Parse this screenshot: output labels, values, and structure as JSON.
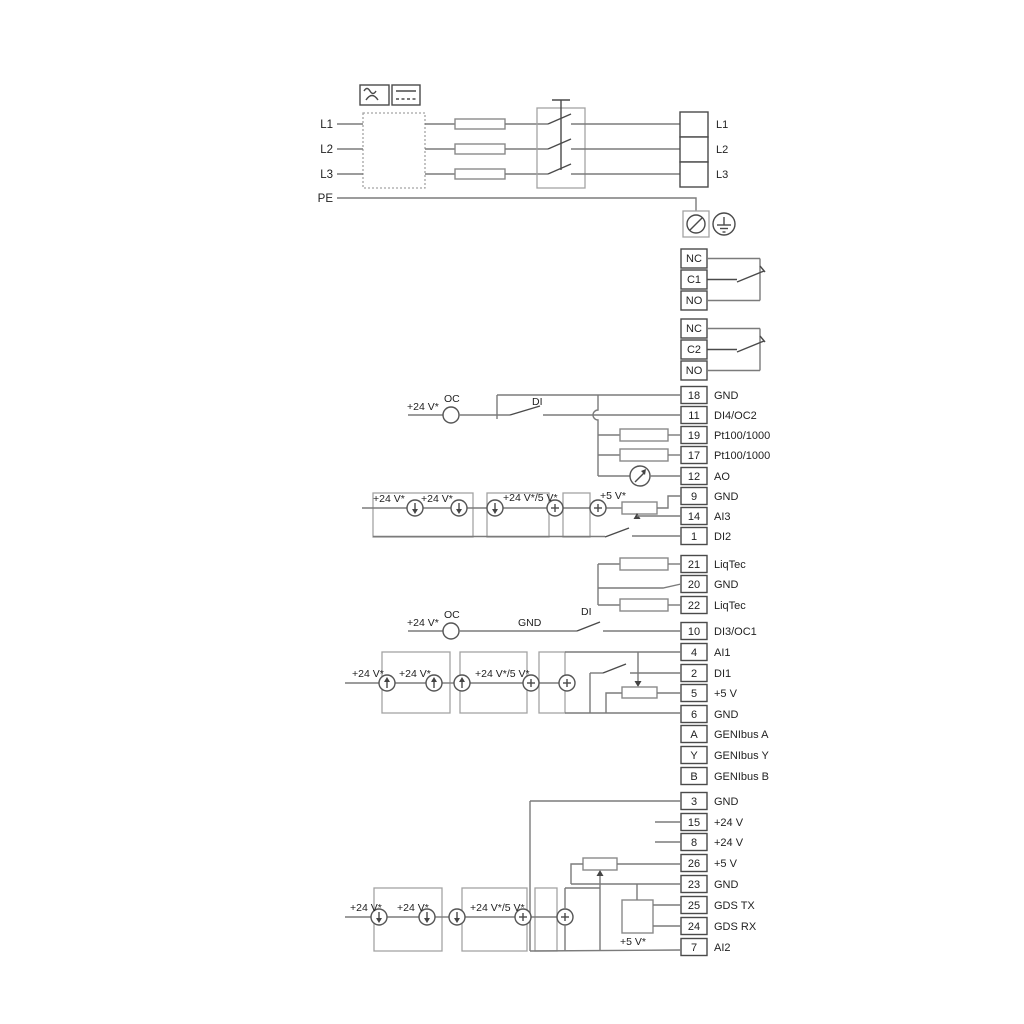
{
  "power": {
    "inputs": [
      "L1",
      "L2",
      "L3",
      "PE"
    ],
    "outputs": [
      "L1",
      "L2",
      "L3"
    ]
  },
  "relays": {
    "r1": [
      "NC",
      "C1",
      "NO"
    ],
    "r2": [
      "NC",
      "C2",
      "NO"
    ]
  },
  "io1": {
    "rows": [
      {
        "num": "18",
        "label": "GND"
      },
      {
        "num": "11",
        "label": "DI4/OC2"
      },
      {
        "num": "19",
        "label": "Pt100/1000"
      },
      {
        "num": "17",
        "label": "Pt100/1000"
      },
      {
        "num": "12",
        "label": "AO"
      },
      {
        "num": "9",
        "label": "GND"
      },
      {
        "num": "14",
        "label": "AI3"
      },
      {
        "num": "1",
        "label": "DI2"
      }
    ]
  },
  "liqtec": {
    "rows": [
      {
        "num": "21",
        "label": "LiqTec"
      },
      {
        "num": "20",
        "label": "GND"
      },
      {
        "num": "22",
        "label": "LiqTec"
      }
    ]
  },
  "io2": {
    "rows": [
      {
        "num": "10",
        "label": "DI3/OC1"
      },
      {
        "num": "4",
        "label": "AI1"
      },
      {
        "num": "2",
        "label": "DI1"
      },
      {
        "num": "5",
        "label": "+5 V"
      },
      {
        "num": "6",
        "label": "GND"
      },
      {
        "num": "A",
        "label": "GENIbus A"
      },
      {
        "num": "Y",
        "label": "GENIbus Y"
      },
      {
        "num": "B",
        "label": "GENIbus B"
      }
    ]
  },
  "io3": {
    "rows": [
      {
        "num": "3",
        "label": "GND"
      },
      {
        "num": "15",
        "label": "+24 V"
      },
      {
        "num": "8",
        "label": "+24 V"
      },
      {
        "num": "26",
        "label": "+5 V"
      },
      {
        "num": "23",
        "label": "GND"
      },
      {
        "num": "25",
        "label": "GDS TX"
      },
      {
        "num": "24",
        "label": "GDS RX"
      },
      {
        "num": "7",
        "label": "AI2"
      }
    ]
  },
  "labels": {
    "v24": "+24 V*",
    "v24_5": "+24 V*/5 V*",
    "v5": "+5 V*",
    "oc": "OC",
    "di": "DI",
    "gnd": "GND"
  },
  "colors": {
    "wire": "#7b7b7b",
    "outline": "#4a4a4a",
    "graybox": "#a3a3a3"
  }
}
